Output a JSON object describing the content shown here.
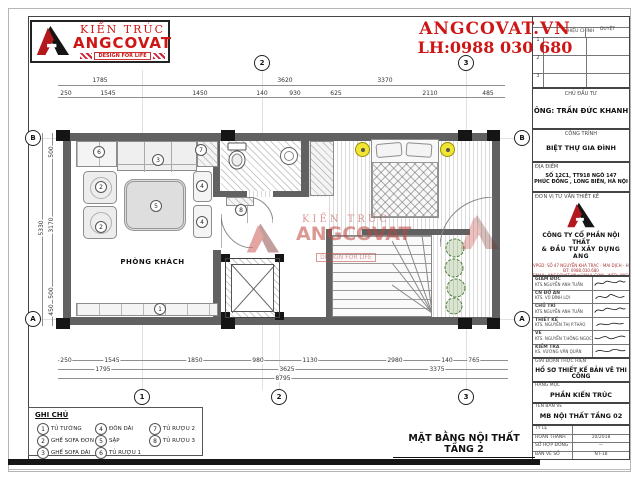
{
  "brand": {
    "kien_truc": "KIẾN TRÚC",
    "name": "ANGCOVAT",
    "tagline": "DESIGN FOR LIFE",
    "website": "ANGCOVAT.VN",
    "hotline": "LH:0988 030 680",
    "accent_red": "#cf1616"
  },
  "plan": {
    "room": "PHÒNG KHÁCH",
    "sheet_title": "MẶT BẰNG NỘI THẤT TẦNG 2",
    "markers": [
      "1",
      "2",
      "2",
      "3",
      "4",
      "4",
      "5",
      "6",
      "7",
      "8"
    ],
    "axes": {
      "top": [
        "2",
        "3"
      ],
      "bottom": [
        "1",
        "2",
        "3"
      ],
      "left": [
        "B",
        "A"
      ],
      "right": [
        "B",
        "A"
      ]
    },
    "dims": {
      "top_row1": [
        "1785",
        "3620"
      ],
      "top_right": "3370",
      "top_row2": [
        "250",
        "1545",
        "1450",
        "140",
        "930",
        "625",
        "2110",
        "485"
      ],
      "bottom_row1": [
        "250",
        "1545",
        "1850",
        "980",
        "1130",
        "2980",
        "140",
        "765"
      ],
      "bottom_row2": [
        "1795",
        "3625",
        "3375"
      ],
      "bottom_total": "8795",
      "left_total": "5330",
      "left_row": [
        "500",
        "3170",
        "500",
        "450"
      ]
    }
  },
  "legend": {
    "title": "GHI CHÚ",
    "items": [
      {
        "num": "1",
        "label": "TỦ TƯỜNG"
      },
      {
        "num": "2",
        "label": "GHẾ SOFA ĐƠN"
      },
      {
        "num": "3",
        "label": "GHẾ SOFA DÀI"
      },
      {
        "num": "4",
        "label": "ĐÔN DÀI"
      },
      {
        "num": "5",
        "label": "SẬP"
      },
      {
        "num": "6",
        "label": "TỦ RƯỢU 1"
      },
      {
        "num": "7",
        "label": "TỦ RƯỢU 2"
      },
      {
        "num": "8",
        "label": "TỦ RƯỢU 3"
      }
    ]
  },
  "title_block": {
    "revision": {
      "header": "HIỆU CHỈNH",
      "approve": "DUYỆT",
      "rows": [
        "1",
        "2",
        "3"
      ]
    },
    "investor_label": "CHỦ ĐẦU TƯ",
    "investor": "ÔNG: TRẦN ĐỨC KHANH",
    "project_label": "CÔNG TRÌNH",
    "project": "BIỆT THỰ GIA ĐÌNH",
    "location_label": "ĐỊA ĐIỂM",
    "location1": "SỐ 12C1, TT918 NGÕ 147",
    "location2": "PHÚC ĐỒNG , LONG BIÊN, HÀ NỘI",
    "consultant_label": "ĐƠN VỊ TƯ VẤN THIẾT KẾ",
    "company1": "CÔNG TY CỔ PHẦN NỘI THẤT",
    "company2": "& ĐẦU TƯ XÂY DỰNG ANG",
    "contact1": "VPGD: SỐ 47 NGUYỄN KHẢ TRẠC - MAI DỊCH - HN",
    "contact2": "ĐT: 0988.030.680",
    "contact3": "EMAIL: ANGCOVAT.VN@GMAIL.COM - WEB: ANGCOVAT.VN",
    "signatures": [
      {
        "role": "GIÁM ĐỐC",
        "name": "KTS.NGUYỄN ANH TUẤN"
      },
      {
        "role": "CN ĐỒ ÁN",
        "name": "KTS. VŨ ĐÌNH LỢI"
      },
      {
        "role": "CHỦ TRÌ",
        "name": "KTS.NGUYỄN ANH TUẤN"
      },
      {
        "role": "THIẾT KẾ",
        "name": "KTS. NGUYỄN THỊ P.THẢO"
      },
      {
        "role": "VẼ",
        "name": "KTS. NGUYỄN T.HỒNG NGỌC"
      },
      {
        "role": "KIỂM TRA",
        "name": "KS. VƯƠNG VĂN QUÂN"
      }
    ],
    "phase_label": "GIAI ĐOẠN THỰC HIỆN",
    "phase": "HỒ SƠ THIẾT KẾ BẢN VẼ THI CÔNG",
    "category_label": "HẠNG MỤC",
    "category": "PHẦN KIẾN TRÚC",
    "drawing_label": "TÊN BẢN VẼ",
    "drawing": "MB NỘI THẤT TẦNG 02",
    "meta": [
      {
        "label": "TỶ LỆ",
        "value": ""
      },
      {
        "label": "HOÀN THÀNH",
        "value": "10/2018"
      },
      {
        "label": "SỐ HỢP ĐỒNG",
        "value": "—"
      },
      {
        "label": "BẢN VẼ SỐ",
        "value": "NT-18"
      }
    ]
  }
}
